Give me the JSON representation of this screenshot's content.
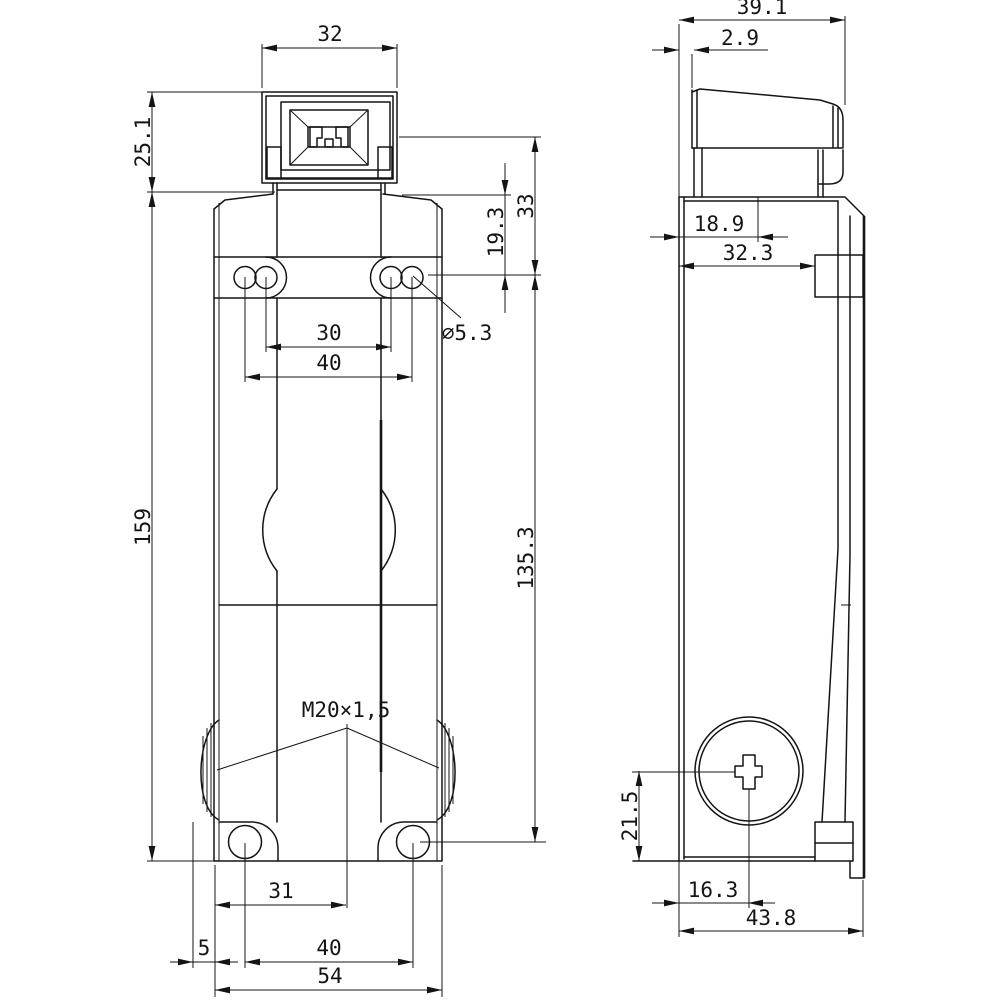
{
  "drawing": {
    "front": {
      "dims": {
        "head_width": "32",
        "head_height": "25.1",
        "total_height": "159",
        "slot_center_to_actuator": "33",
        "slot_center_to_top": "19.3",
        "hole_dia": "⌀5.3",
        "slot_pitch_inner": "30",
        "slot_pitch_outer": "40",
        "slot_to_gland_center": "135.3",
        "gland_thread": "M20×1,5",
        "edge_to_gland": "31",
        "cap_protrusion": "5",
        "hole_pitch_bottom": "40",
        "base_width": "54"
      }
    },
    "side": {
      "dims": {
        "head_depth": "39.1",
        "head_setback": "2.9",
        "plunger_plane": "18.9",
        "body_depth": "32.3",
        "gland_center_height": "21.5",
        "gland_center_depth": "16.3",
        "overall_depth": "43.8"
      }
    },
    "colors": {
      "line": "#141414",
      "background": "#ffffff"
    }
  }
}
